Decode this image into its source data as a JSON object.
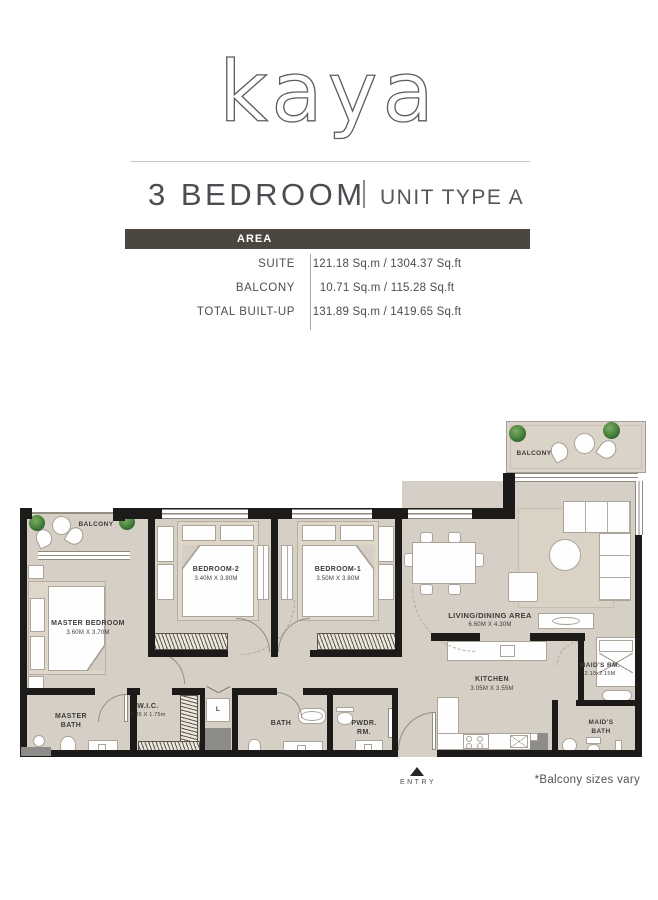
{
  "brand": {
    "logo": "kaya"
  },
  "header": {
    "title": "3 BEDROOM",
    "subtitle": "UNIT TYPE A"
  },
  "area_table": {
    "header": "AREA",
    "rows": [
      {
        "label": "SUITE",
        "value": "121.18 Sq.m / 1304.37 Sq.ft"
      },
      {
        "label": "BALCONY",
        "value": "10.71 Sq.m / 115.28 Sq.ft"
      },
      {
        "label": "TOTAL BUILT-UP",
        "value": "131.89 Sq.m / 1419.65 Sq.ft"
      }
    ]
  },
  "floorplan": {
    "rooms": {
      "balcony_top": {
        "name": "BALCONY"
      },
      "balcony_left": {
        "name": "BALCONY"
      },
      "master_bedroom": {
        "name": "MASTER BEDROOM",
        "dims": "3.60M X 3.70M"
      },
      "bedroom_2": {
        "name": "BEDROOM-2",
        "dims": "3.40M X 3.80M"
      },
      "bedroom_1": {
        "name": "BEDROOM-1",
        "dims": "3.50M X 3.80M"
      },
      "living_dining": {
        "name": "LIVING/DINING AREA",
        "dims": "6.60M X 4.30M"
      },
      "kitchen": {
        "name": "KITCHEN",
        "dims": "3.05M X 3.55M"
      },
      "maids_room": {
        "name": "MAID'S RM.",
        "dims": "2.10x2.15M"
      },
      "maids_bath": {
        "name": "MAID'S BATH"
      },
      "master_bath": {
        "name": "MASTER BATH"
      },
      "wic": {
        "name": "W.I.C.",
        "dims": "2.35 X 1.75m"
      },
      "bath": {
        "name": "BATH"
      },
      "powder_room": {
        "name": "PWDR. RM."
      },
      "laundry": {
        "name": "L"
      }
    },
    "entry_label": "ENTRY",
    "footnote": "*Balcony sizes vary"
  },
  "colors": {
    "area_band_bg": "#4b463f",
    "wall": "#1c1b19",
    "floor": "#d6cfc5",
    "plant_green": "#4d8742",
    "text_gray": "#4c4d52"
  }
}
